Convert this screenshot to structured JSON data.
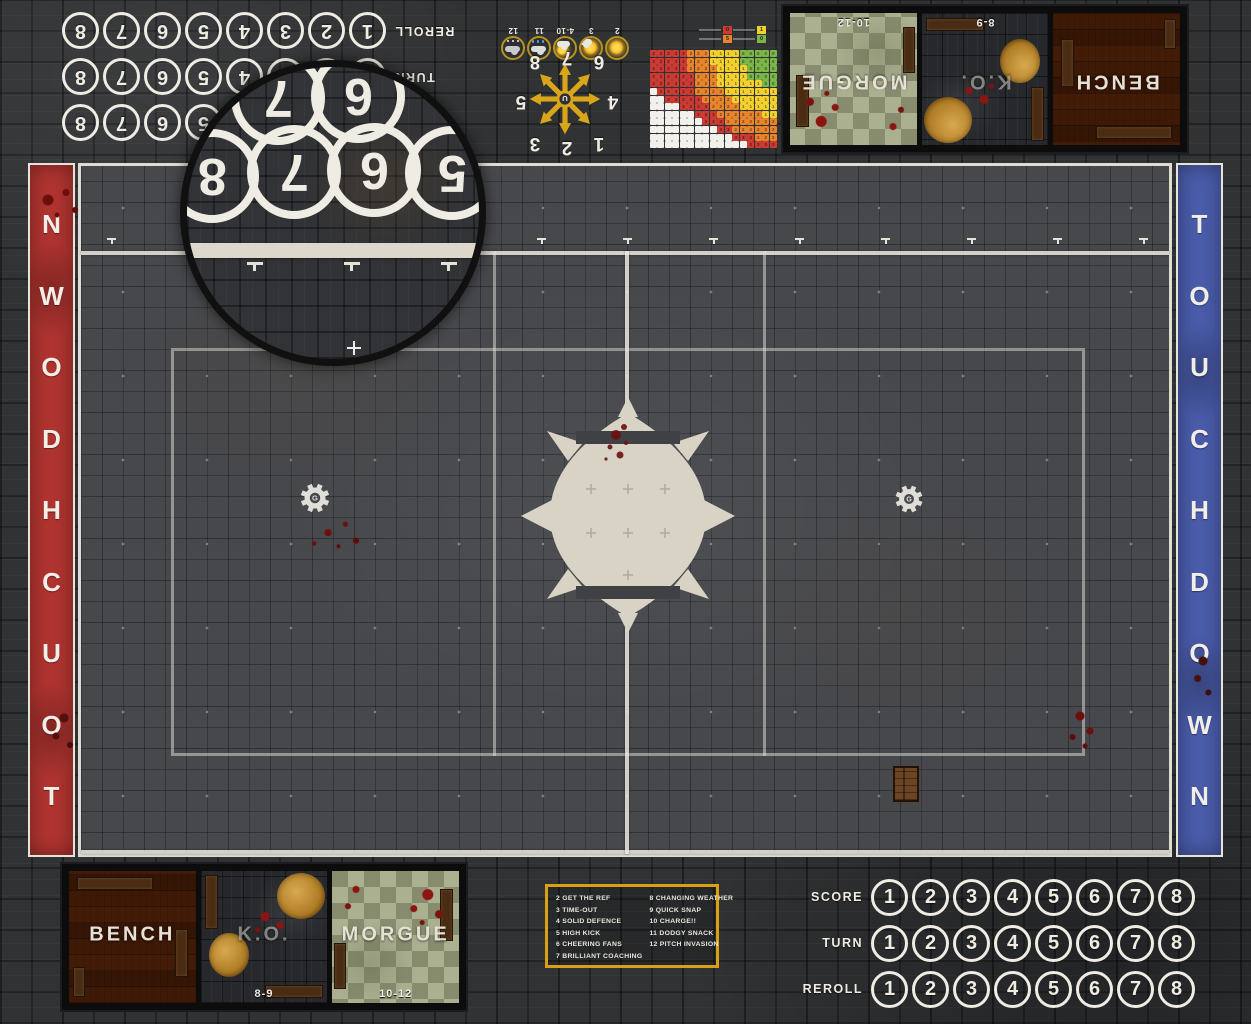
{
  "colors": {
    "accent_gold": "#d99f16",
    "banner_red": "#b13430",
    "banner_blue": "#4a5cab",
    "line_white": "#efece3",
    "blood": "#6e1110"
  },
  "banners": {
    "left": {
      "text": "TOUCHDOWN",
      "direction": "bottom-to-top",
      "color": "#b13430"
    },
    "right": {
      "text": "TOUCHDOWN",
      "direction": "top-to-bottom",
      "color": "#4a5cab"
    }
  },
  "trackers": {
    "bottom_right": {
      "rotated": false,
      "rows": [
        {
          "label": "SCORE",
          "numbers": [
            "1",
            "2",
            "3",
            "4",
            "5",
            "6",
            "7",
            "8"
          ]
        },
        {
          "label": "TURN",
          "numbers": [
            "1",
            "2",
            "3",
            "4",
            "5",
            "6",
            "7",
            "8"
          ]
        },
        {
          "label": "REROLL",
          "numbers": [
            "1",
            "2",
            "3",
            "4",
            "5",
            "6",
            "7",
            "8"
          ]
        }
      ]
    },
    "top_left": {
      "rotated": true,
      "rows": [
        {
          "label": "SCORE",
          "numbers": [
            "1",
            "2",
            "3",
            "4",
            "5",
            "6",
            "7",
            "8"
          ]
        },
        {
          "label": "TURN",
          "numbers": [
            "1",
            "2",
            "3",
            "4",
            "5",
            "6",
            "7",
            "8"
          ]
        },
        {
          "label": "REROLL",
          "numbers": [
            "1",
            "2",
            "3",
            "4",
            "5",
            "6",
            "7",
            "8"
          ]
        }
      ]
    }
  },
  "weather": {
    "rotated": true,
    "items": [
      {
        "value": "2",
        "icon": "sun-icon"
      },
      {
        "value": "3",
        "icon": "sun-small-cloud-icon"
      },
      {
        "value": "4-10",
        "icon": "sun-cloud-icon"
      },
      {
        "value": "11",
        "icon": "rain-cloud-icon"
      },
      {
        "value": "12",
        "icon": "storm-cloud-icon"
      }
    ]
  },
  "scatter_template": {
    "rotated": true,
    "numbers": [
      "1",
      "2",
      "3",
      "4",
      "5",
      "6",
      "7",
      "8"
    ]
  },
  "kickoff_table": {
    "left_column": [
      "2 GET THE REF",
      "3 TIME-OUT",
      "4 SOLID DEFENCE",
      "5 HIGH KICK",
      "6 CHEERING FANS",
      "7 BRILLIANT COACHING"
    ],
    "right_column": [
      "8 CHANGING WEATHER",
      "9 QUICK SNAP",
      "10 CHARGE!!",
      "11 DODGY SNACK",
      "12 PITCH INVASION"
    ]
  },
  "dugouts": {
    "bottom_left": {
      "rotated": false,
      "panels": [
        {
          "name": "BENCH",
          "style": "wood",
          "range": ""
        },
        {
          "name": "K.O.",
          "style": "stone",
          "range": "8-9"
        },
        {
          "name": "MORGUE",
          "style": "checker",
          "range": "10-12"
        }
      ]
    },
    "top_right": {
      "rotated": true,
      "panels": [
        {
          "name": "BENCH",
          "style": "wood",
          "range": ""
        },
        {
          "name": "K.O.",
          "style": "stone",
          "range": "8-9"
        },
        {
          "name": "MORGUE",
          "style": "checker",
          "range": "10-12"
        }
      ]
    }
  },
  "lens": {
    "numbers_back_row": [
      "7",
      "6"
    ],
    "numbers_front_row": [
      "8",
      "7",
      "6",
      "5"
    ]
  },
  "chart_data": {
    "type": "heatmap",
    "title": "",
    "cols": 17,
    "rows": 13,
    "origin": "top-right",
    "grid": true,
    "bands": [
      {
        "name": "green",
        "color": "#7ab648",
        "value": "0",
        "max_distance": 4.3
      },
      {
        "name": "yellow",
        "color": "#f2d12e",
        "value": "1",
        "max_distance": 8.2
      },
      {
        "name": "orange",
        "color": "#e8842c",
        "value": "2",
        "max_distance": 11.2
      },
      {
        "name": "red",
        "color": "#cc3b33",
        "value": "3",
        "max_distance": 99
      }
    ],
    "blank_rule": "white staircase lower-left: blank if row >= 5 + 0.58*col",
    "legend": [
      {
        "color": "#cc3b33",
        "value": "0"
      },
      {
        "color": "#e8842c",
        "value": "5"
      },
      {
        "color": "#f2d12e",
        "value": "1"
      },
      {
        "color": "#7ab648",
        "value": "0"
      }
    ]
  }
}
